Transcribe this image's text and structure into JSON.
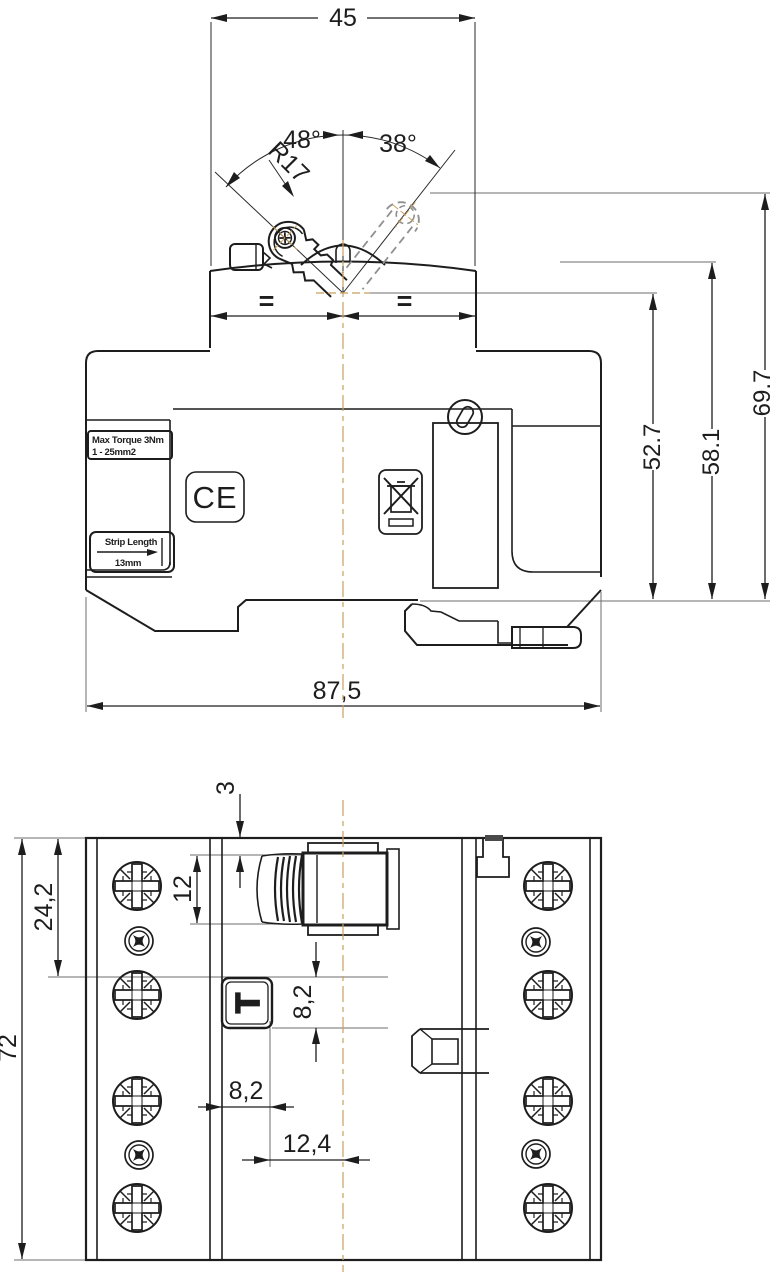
{
  "top_view": {
    "width_top": "45",
    "angle_left": "48°",
    "angle_right": "38°",
    "lever_radius": "R17",
    "equal_mark_left": "=",
    "equal_mark_right": "=",
    "height_to_pivot": "52.7",
    "height_to_housing": "58.1",
    "height_to_lever": "69.7",
    "overall_width": "87,5",
    "max_torque_label_line1": "Max Torque 3Nm",
    "max_torque_label_line2": "1 - 25mm2",
    "strip_length_label": "Strip Length",
    "strip_length_value": "13mm",
    "ce_mark": "CE"
  },
  "bottom_view": {
    "handle_offset": "3",
    "handle_width": "12",
    "terminal_spacing": "24,2",
    "overall_height": "72",
    "test_button_offset_v": "8,2",
    "test_button_offset_h": "8,2",
    "center_offset": "12,4",
    "test_button_label": "T"
  },
  "colors": {
    "line": "#1d1d1d",
    "centerline": "#c8a05e",
    "phantom": "#8f8f8f",
    "extension": "#6e6e6e"
  }
}
